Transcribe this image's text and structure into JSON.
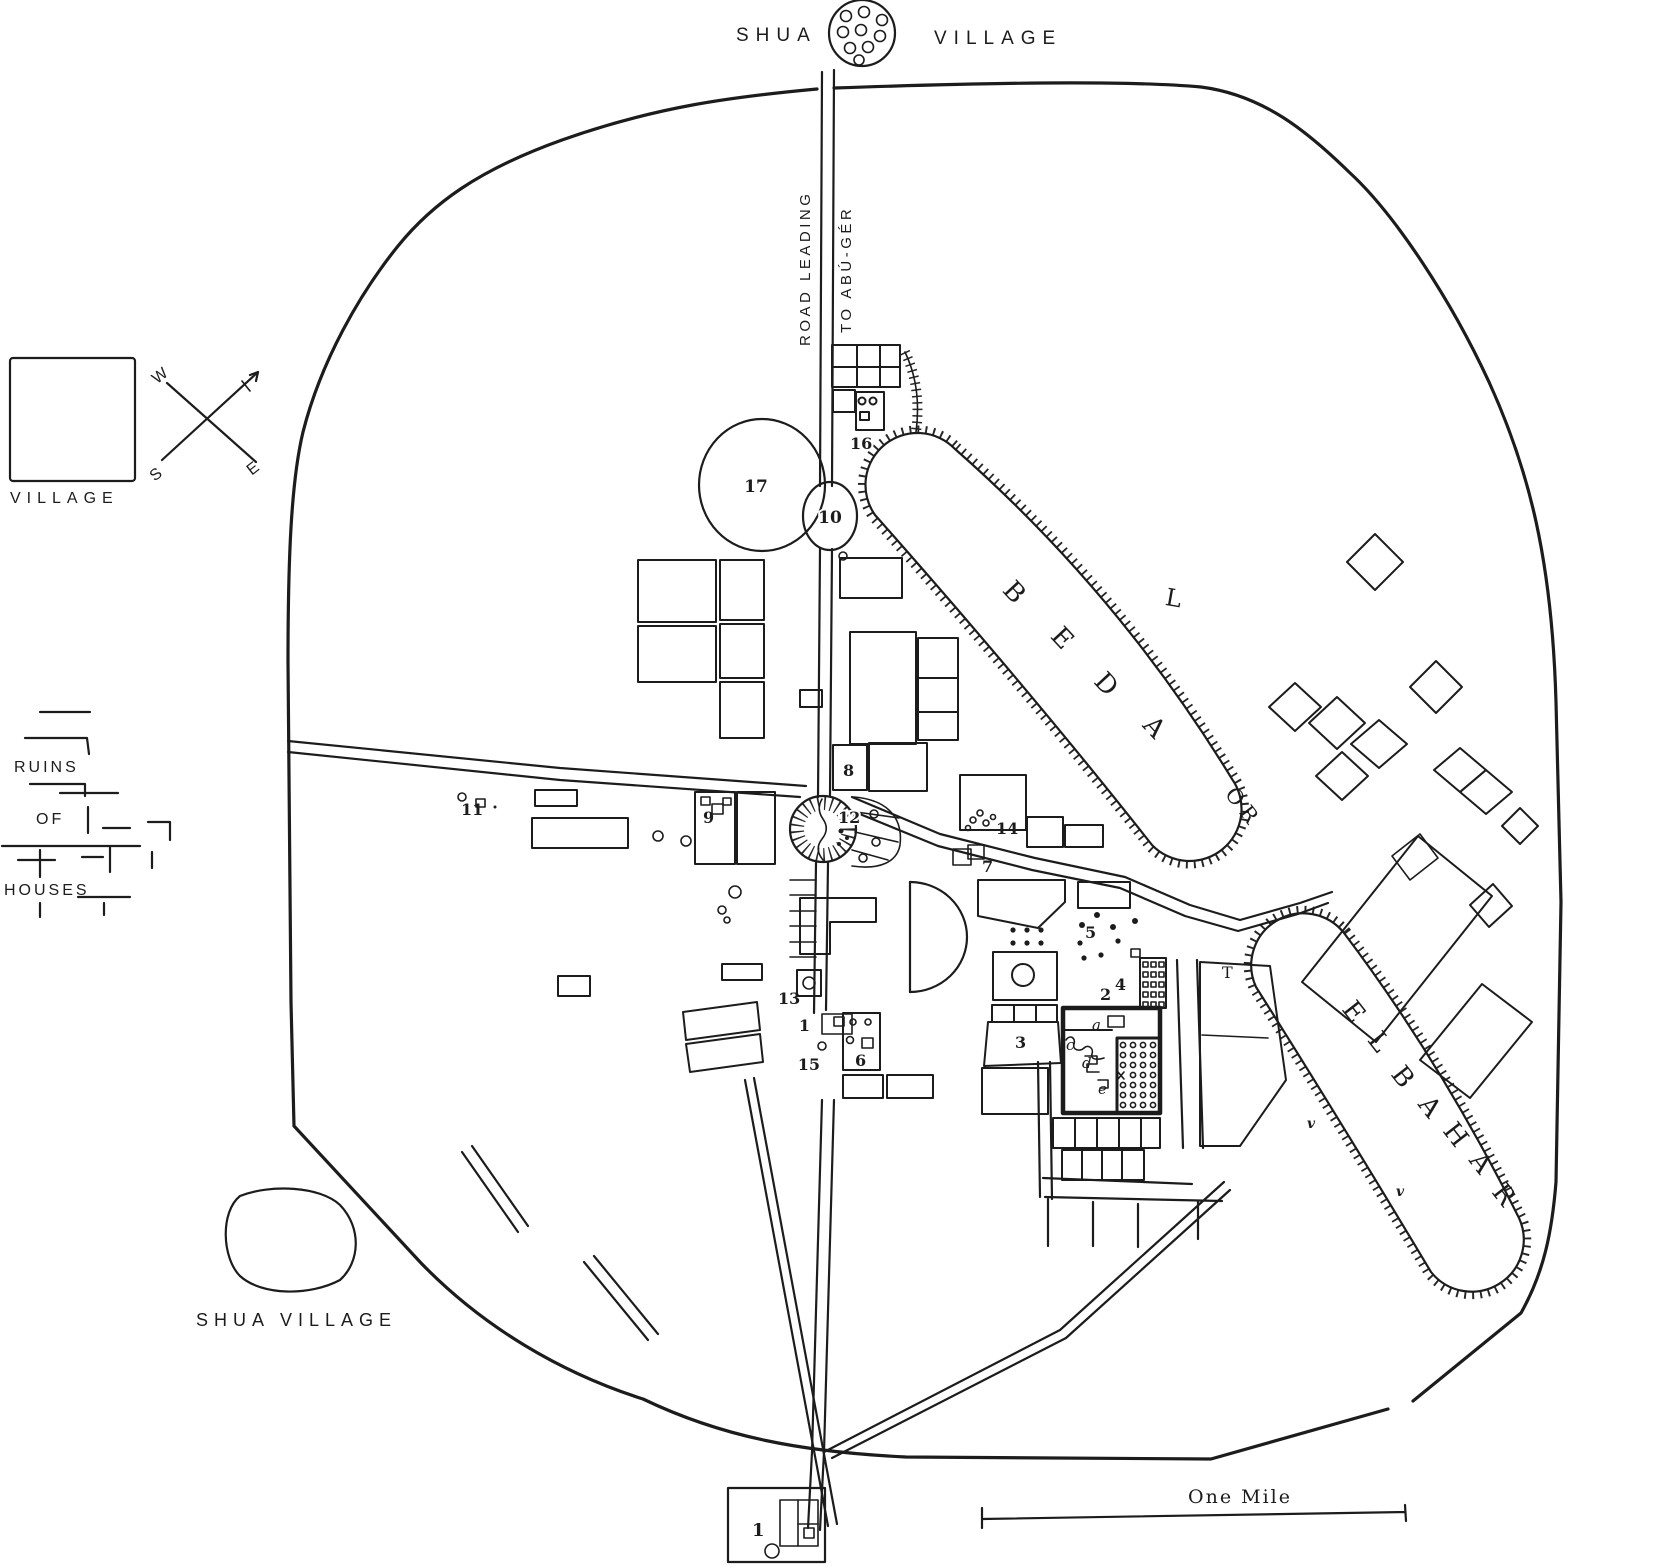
{
  "title": {
    "left": "SHUA",
    "right": "VILLAGE"
  },
  "road": {
    "line1": "ROAD LEADING",
    "line2": "TO ABÚ-GÉR"
  },
  "legend": {
    "village_label": "VILLAGE",
    "ruins": {
      "l1": "RUINS",
      "l2": "OF",
      "l3": "HOUSES"
    },
    "compass": {
      "w": "W",
      "e": "E",
      "s": "S"
    }
  },
  "water": {
    "beda": {
      "chars": [
        "B",
        "E",
        "D",
        "A"
      ],
      "suffix": "OR"
    },
    "bahar": {
      "chars": [
        "E",
        "L",
        "B",
        "A",
        "H",
        "A",
        "R"
      ]
    },
    "marks": {
      "v": "v"
    }
  },
  "south_village": {
    "label": "SHUA VILLAGE"
  },
  "scale": {
    "label": "One Mile"
  },
  "markers": {
    "m1": "1",
    "m2": "2",
    "m3": "3",
    "m4": "4",
    "m5": "5",
    "m6": "6",
    "m7": "7",
    "m8": "8",
    "m9": "9",
    "m10": "10",
    "m11": "11",
    "m12": "12",
    "m13": "13",
    "m14": "14",
    "m15": "15",
    "m16": "16",
    "m17": "17"
  },
  "letters": {
    "a": "a",
    "c": "c",
    "d": "d",
    "e": "e",
    "t": "T",
    "l_mark": "L"
  },
  "colors": {
    "ink": "#1c1c1c",
    "paper": "#ffffff"
  }
}
